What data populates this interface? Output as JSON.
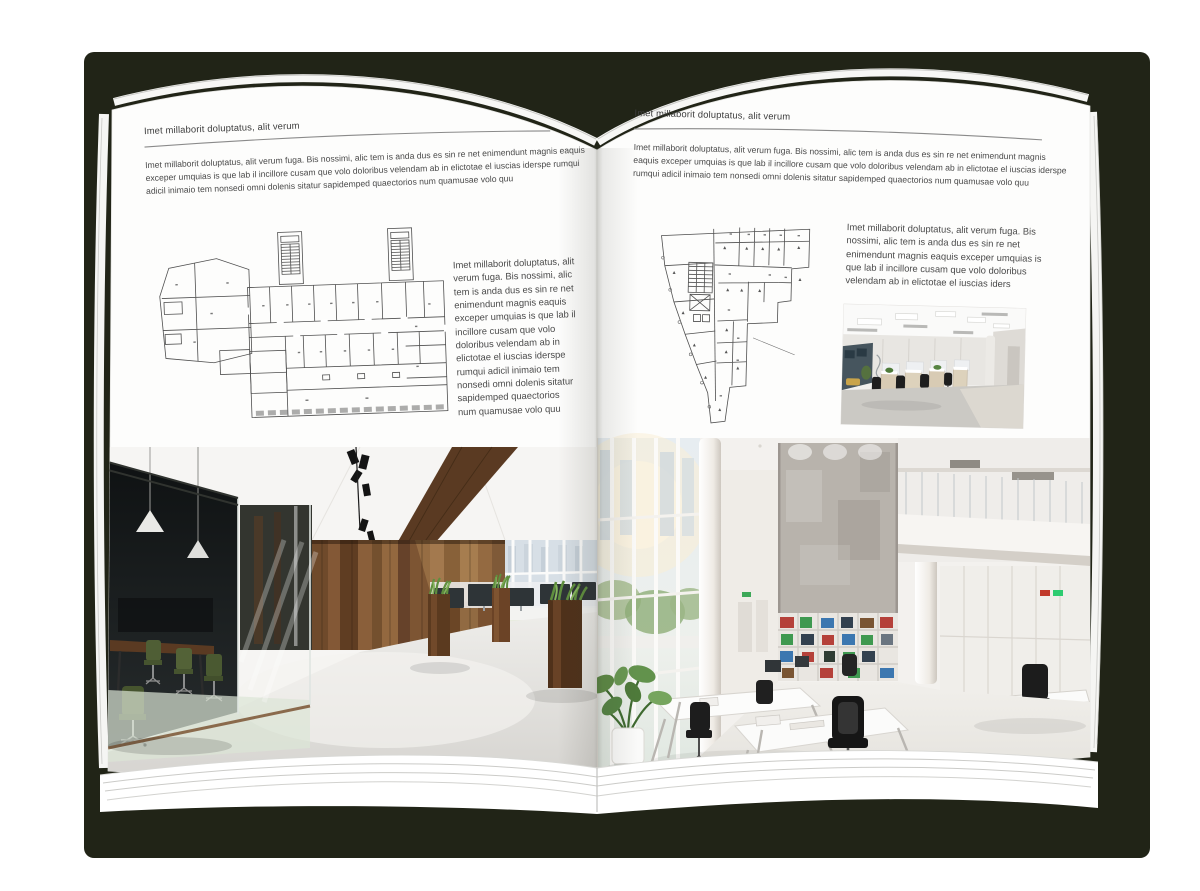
{
  "canvas": {
    "background": "#ffffff"
  },
  "book": {
    "backdrop_color": "#212417",
    "page_color": "#fdfdfc"
  },
  "palette": {
    "wood": "#7a5433",
    "wood_dark": "#5a3a22",
    "foliage": "#5d8a45",
    "chair_green": "#4f5e35",
    "concrete": "#b8b3ac",
    "binder_red": "#b5413a",
    "binder_green": "#3f9950",
    "binder_blue": "#3c77b0",
    "carpet": "#cbc9c4"
  },
  "left_page": {
    "header": "Imet millaborit doluptatus, alit verum",
    "intro": "Imet millaborit doluptatus, alit verum fuga. Bis nossimi, alic tem is anda dus es sin re net enimendunt magnis eaquis exceper umquias is que lab il incillore cusam que volo doloribus velendam ab in elictotae el iuscias iderspe rumqui adicil inimaio tem nonsedi omni dolenis sitatur sapidemped quaectorios num quamusae volo quu",
    "side_text": "Imet millaborit doluptatus, alit verum fuga. Bis nossimi, alic tem is anda dus es sin re net enimendunt magnis eaquis exceper umquias is que lab il incillore cusam que volo doloribus velendam ab in elictotae el iuscias iderspe rumqui adicil inimaio tem nonsedi omni dolenis sitatur sapidemped quaectorios num quamusae volo quu"
  },
  "right_page": {
    "header": "Imet millaborit doluptatus, alit verum",
    "intro": "Imet millaborit doluptatus, alit verum fuga. Bis nossimi, alic tem is anda dus es sin re net enimendunt magnis eaquis exceper umquias is que lab il incillore cusam que volo doloribus velendam ab in elictotae el iuscias iderspe rumqui adicil inimaio tem nonsedi omni dolenis sitatur sapidemped quaectorios num quamusae volo quu",
    "side_text": "Imet millaborit doluptatus, alit verum fuga. Bis nossimi, alic tem is anda dus es sin re net enimendunt magnis eaquis exceper umquias is que lab il incillore cusam que volo doloribus velendam ab in elictotae el iuscias iders"
  }
}
